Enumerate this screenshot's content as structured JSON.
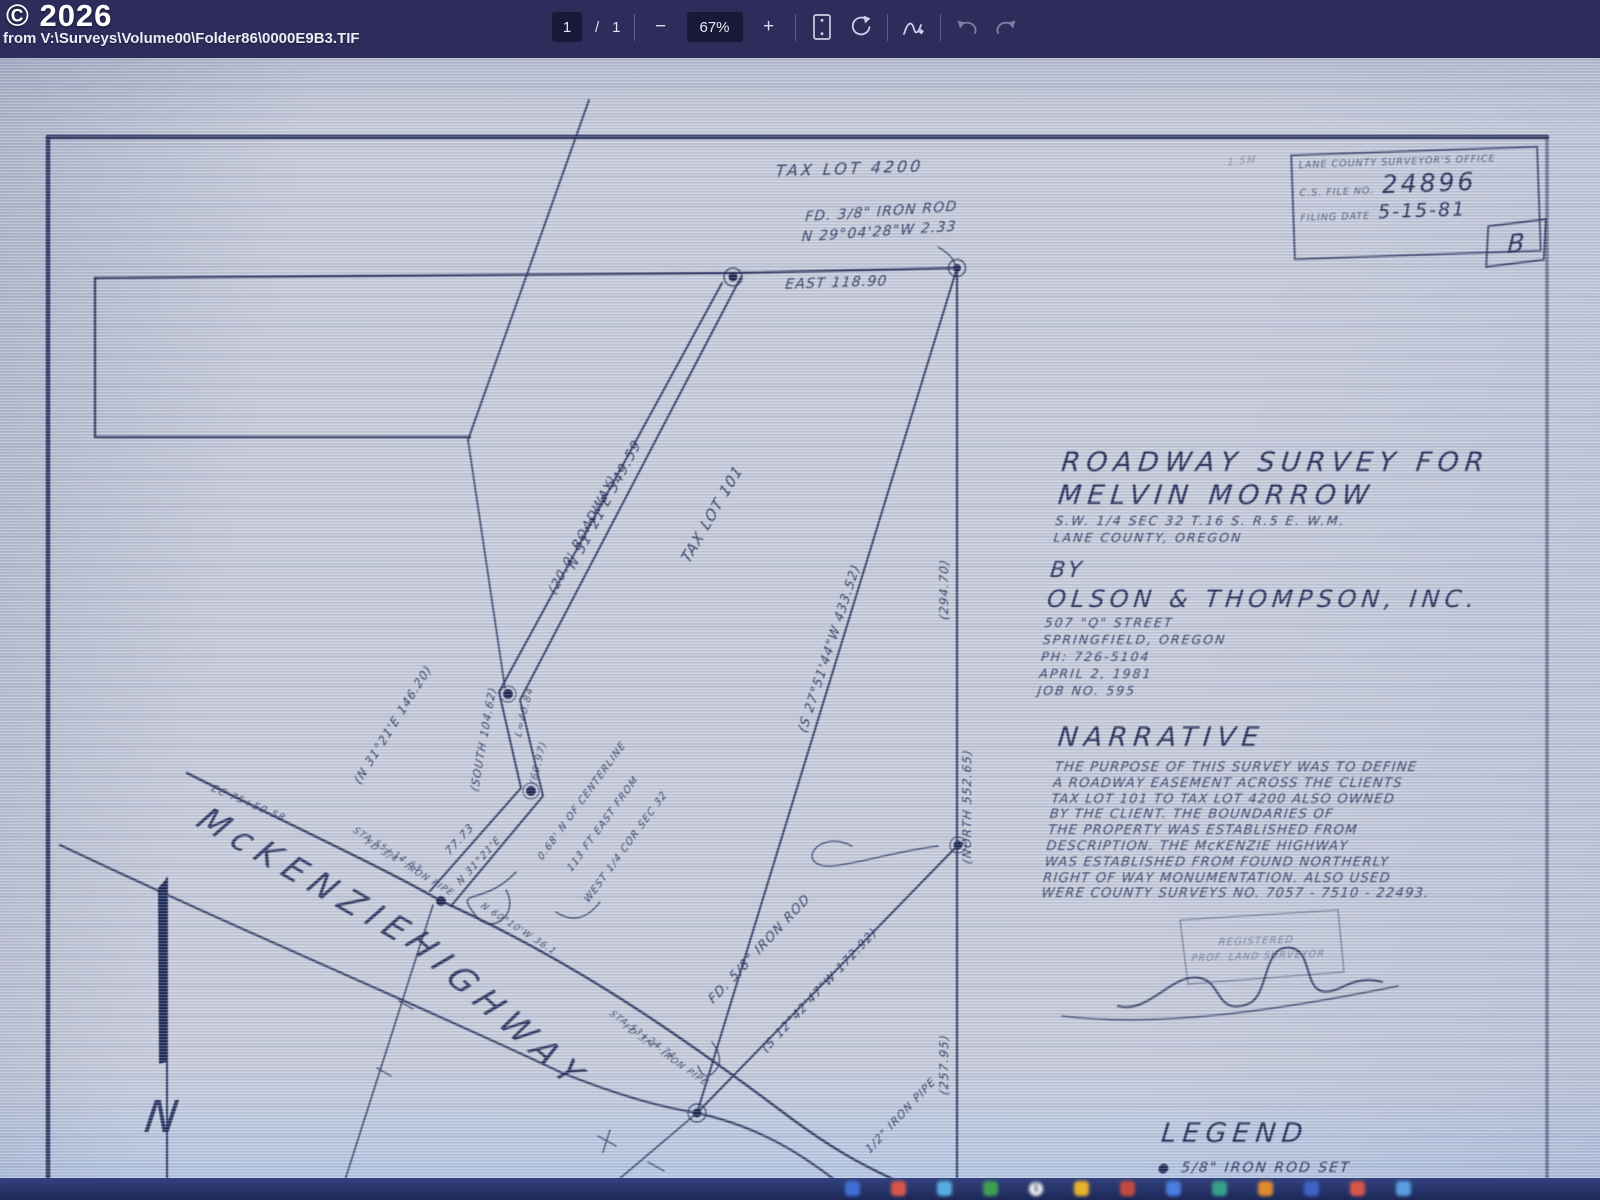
{
  "viewer": {
    "watermark": "© 2026",
    "source": "from V:\\Surveys\\Volume00\\Folder86\\0000E9B3.TIF",
    "page_current": "1",
    "page_divider": "/",
    "page_total": "1",
    "zoom_out": "−",
    "zoom_level": "67%",
    "zoom_in": "+"
  },
  "colors": {
    "toolbar_bg": "#2d2c5a",
    "paper": "#c6cbda",
    "ink": "#212b56",
    "taskbar_bg": "#273566"
  },
  "stamp": {
    "office_line": "LANE COUNTY SURVEYOR'S OFFICE",
    "file_label": "C.S. FILE NO.",
    "file_number": "24896",
    "date_label": "FILING DATE",
    "date_value": "5-15-81",
    "revision": "B"
  },
  "title_block": {
    "line1": "ROADWAY SURVEY FOR",
    "line2": "MELVIN MORROW",
    "line3": "S.W. 1/4 SEC 32 T.16 S. R.5 E. W.M.",
    "line4": "LANE COUNTY, OREGON",
    "by": "BY",
    "company": "OLSON & THOMPSON, INC.",
    "address1": "507 \"Q\" STREET",
    "address2": "SPRINGFIELD, OREGON",
    "phone": "PH: 726-5104",
    "date": "APRIL 2, 1981",
    "job": "JOB NO. 595"
  },
  "narrative": {
    "heading": "NARRATIVE",
    "lines": [
      "THE PURPOSE OF THIS SURVEY WAS TO DEFINE",
      "A ROADWAY EASEMENT ACROSS THE CLIENTS",
      "TAX LOT 101 TO TAX LOT 4200 ALSO OWNED",
      "BY THE CLIENT. THE BOUNDARIES OF",
      "THE PROPERTY WAS ESTABLISHED FROM",
      "DESCRIPTION. THE McKENZIE HIGHWAY",
      "WAS ESTABLISHED FROM FOUND NORTHERLY",
      "RIGHT OF WAY MONUMENTATION. ALSO USED",
      "WERE COUNTY SURVEYS NO. 7057 - 7510 - 22493."
    ]
  },
  "legend": {
    "heading": "LEGEND",
    "symbol": "●",
    "item": "5/8\" IRON ROD SET"
  },
  "map_labels": [
    {
      "t": "TAX LOT  4200",
      "x": 849,
      "y": 174,
      "r": -2,
      "s": 16,
      "ls": 3
    },
    {
      "t": "FD. 3/8\" IRON ROD",
      "x": 881,
      "y": 216,
      "r": -4,
      "s": 14
    },
    {
      "t": "N 29°04'28\"W  2.33",
      "x": 879,
      "y": 236,
      "r": -4,
      "s": 14
    },
    {
      "t": "EAST  118.90",
      "x": 836,
      "y": 287,
      "r": -2,
      "s": 14
    },
    {
      "t": "N 31°21'E  349.59",
      "x": 608,
      "y": 507,
      "r": -62,
      "s": 14
    },
    {
      "t": "(20.0' ROADWAY)",
      "x": 586,
      "y": 537,
      "r": -62,
      "s": 13
    },
    {
      "t": "TAX LOT 101",
      "x": 716,
      "y": 517,
      "r": -60,
      "s": 15
    },
    {
      "t": "(S 27°51'44\"W  433.52)",
      "x": 833,
      "y": 650,
      "r": -72,
      "s": 13
    },
    {
      "t": "(294.70)",
      "x": 948,
      "y": 590,
      "r": -90,
      "s": 12
    },
    {
      "t": "(NORTH  552.65)",
      "x": 971,
      "y": 807,
      "r": -90,
      "s": 12
    },
    {
      "t": "(257.95)",
      "x": 948,
      "y": 1065,
      "r": -90,
      "s": 12
    },
    {
      "t": "(N 31°21'E  146.20)",
      "x": 396,
      "y": 727,
      "r": -58,
      "s": 12
    },
    {
      "t": "(SOUTH  104.62)",
      "x": 487,
      "y": 740,
      "r": -80,
      "s": 11
    },
    {
      "t": "L=40.84",
      "x": 527,
      "y": 713,
      "r": -76,
      "s": 10,
      "o": 0.8
    },
    {
      "t": "(60.97)",
      "x": 541,
      "y": 764,
      "r": -76,
      "s": 10,
      "o": 0.8
    },
    {
      "t": "77.73",
      "x": 462,
      "y": 842,
      "r": -48,
      "s": 11
    },
    {
      "t": "N 31°21'E",
      "x": 481,
      "y": 863,
      "r": -48,
      "s": 10
    },
    {
      "t": "0.68' N OF CENTERLINE",
      "x": 584,
      "y": 803,
      "r": -54,
      "s": 10
    },
    {
      "t": "113 FT EAST FROM",
      "x": 605,
      "y": 826,
      "r": -54,
      "s": 10
    },
    {
      "t": "WEST 1/4 COR SEC 32",
      "x": 628,
      "y": 849,
      "r": -54,
      "s": 10
    },
    {
      "t": "EC 75+50.58",
      "x": 247,
      "y": 806,
      "r": 23,
      "s": 10,
      "o": 0.85
    },
    {
      "t": "STA 55+14.63",
      "x": 386,
      "y": 852,
      "r": 31,
      "s": 9,
      "o": 0.85
    },
    {
      "t": "FD 3/4\" IRON PIPE",
      "x": 408,
      "y": 870,
      "r": 31,
      "s": 9,
      "o": 0.85
    },
    {
      "t": "N 60°10'W  36.1",
      "x": 517,
      "y": 931,
      "r": 33,
      "s": 9,
      "o": 0.85
    },
    {
      "t": "STA 53+24.74",
      "x": 641,
      "y": 1037,
      "r": 35,
      "s": 9,
      "o": 0.85
    },
    {
      "t": "FD 3/4\" IRON PIPE",
      "x": 664,
      "y": 1057,
      "r": 35,
      "s": 9,
      "o": 0.85
    },
    {
      "t": "FD. 5/8\" IRON ROD",
      "x": 762,
      "y": 952,
      "r": -47,
      "s": 13
    },
    {
      "t": "(S 12°42'47\"W  172.92)",
      "x": 822,
      "y": 993,
      "r": -47,
      "s": 12
    },
    {
      "t": "1/2\" IRON PIPE",
      "x": 903,
      "y": 1118,
      "r": -47,
      "s": 11
    },
    {
      "t": "McKENZIE",
      "x": 300,
      "y": 886,
      "r": 30,
      "s": 34,
      "ls": 9
    },
    {
      "t": "HIGHWAY",
      "x": 489,
      "y": 1018,
      "r": 41,
      "s": 34,
      "ls": 9
    },
    {
      "t": "REGISTERED",
      "x": 1256,
      "y": 944,
      "r": -2,
      "s": 10,
      "o": 0.5
    },
    {
      "t": "PROF. LAND SURVEYOR",
      "x": 1258,
      "y": 959,
      "r": -2,
      "s": 9.5,
      "o": 0.5
    },
    {
      "t": "1.5M",
      "x": 1242,
      "y": 164,
      "r": -6,
      "s": 10,
      "o": 0.4
    },
    {
      "t": "N",
      "x": 160,
      "y": 1132,
      "r": 0,
      "s": 44
    }
  ],
  "taskbar": {
    "icons": [
      {
        "c": "#3f6fd6"
      },
      {
        "c": "#d6574a"
      },
      {
        "c": "#58aee2"
      },
      {
        "c": "#3fa054"
      },
      {
        "badge": "1"
      },
      {
        "c": "#e8b12e"
      },
      {
        "c": "#c44a3f"
      },
      {
        "c": "#4a7de0"
      },
      {
        "c": "#39a08c"
      },
      {
        "c": "#e08a2e"
      },
      {
        "c": "#3f63c9"
      },
      {
        "c": "#d6574a"
      },
      {
        "c": "#5a9de0"
      }
    ]
  }
}
